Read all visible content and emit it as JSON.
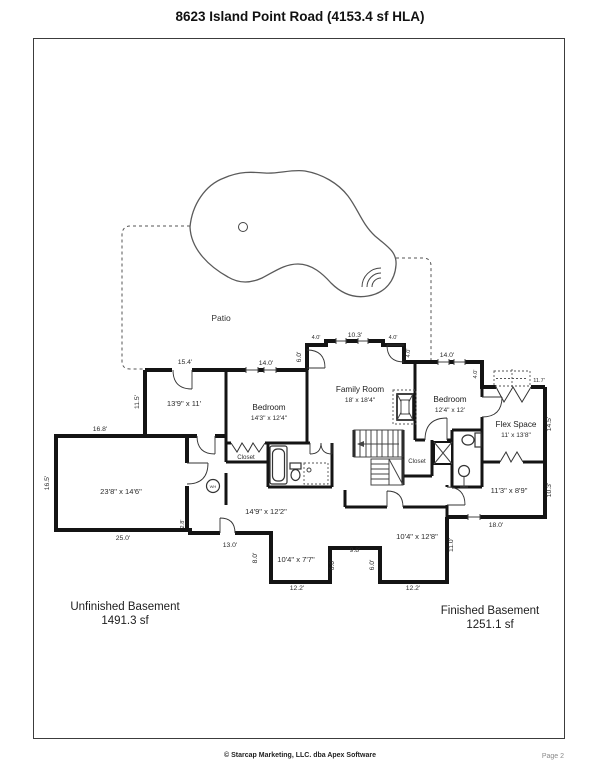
{
  "page": {
    "title": "8623 Island Point Road (4153.4 sf HLA)",
    "footer_copyright": "© Starcap Marketing, LLC. dba Apex Software",
    "footer_page": "Page 2"
  },
  "areas": {
    "unfinished": {
      "name": "Unfinished Basement",
      "sqft": "1491.3 sf"
    },
    "finished": {
      "name": "Finished Basement",
      "sqft": "1251.1 sf"
    }
  },
  "colors": {
    "wall": "#141414",
    "dashed": "#555555",
    "text": "#222222",
    "page_bg": "#ffffff"
  },
  "labels": [
    {
      "t": "Patio",
      "x": 221,
      "y": 321,
      "s": "patio",
      "n": "patio-label"
    },
    {
      "t": "Family Room",
      "x": 360,
      "y": 392,
      "s": "room",
      "n": "room-label"
    },
    {
      "t": "18' x 18'4\"",
      "x": 360,
      "y": 402,
      "s": "roomsub",
      "n": "room-size-label"
    },
    {
      "t": "Bedroom",
      "x": 269,
      "y": 410,
      "s": "room",
      "n": "room-label"
    },
    {
      "t": "14'3\" x 12'4\"",
      "x": 269,
      "y": 420,
      "s": "roomsub",
      "n": "room-size-label"
    },
    {
      "t": "Bedroom",
      "x": 450,
      "y": 402,
      "s": "room",
      "n": "room-label"
    },
    {
      "t": "12'4\" x 12'",
      "x": 450,
      "y": 412,
      "s": "roomsub",
      "n": "room-size-label"
    },
    {
      "t": "Flex Space",
      "x": 516,
      "y": 427,
      "s": "room",
      "n": "room-label"
    },
    {
      "t": "11' x 13'8\"",
      "x": 516,
      "y": 437,
      "s": "roomsub",
      "n": "room-size-label"
    },
    {
      "t": "13'9\" x 11'",
      "x": 184,
      "y": 406,
      "s": "roomdim",
      "n": "room-size-label"
    },
    {
      "t": "23'8\" x 14'6\"",
      "x": 121,
      "y": 494,
      "s": "roomdim",
      "n": "room-size-label"
    },
    {
      "t": "14'9\" x 12'2\"",
      "x": 266,
      "y": 514,
      "s": "roomdim",
      "n": "room-size-label"
    },
    {
      "t": "11'3\" x 8'9\"",
      "x": 509,
      "y": 493,
      "s": "roomdim",
      "n": "room-size-label"
    },
    {
      "t": "10'4\" x 7'7\"",
      "x": 296,
      "y": 562,
      "s": "roomdim",
      "n": "room-size-label"
    },
    {
      "t": "10'4\" x 12'8\"",
      "x": 417,
      "y": 539,
      "s": "roomdim",
      "n": "room-size-label"
    },
    {
      "t": "Closet",
      "x": 246,
      "y": 459,
      "s": "closet",
      "n": "closet-label"
    },
    {
      "t": "Closet",
      "x": 417,
      "y": 463,
      "s": "closet",
      "n": "closet-label"
    },
    {
      "t": "WH",
      "x": 213,
      "y": 488,
      "s": "wh",
      "n": "water-heater-label"
    },
    {
      "t": "10.3'",
      "x": 355,
      "y": 337,
      "s": "dim",
      "n": "dimension-label"
    },
    {
      "t": "4.0'",
      "x": 316,
      "y": 339,
      "s": "dimsmall",
      "n": "dimension-label"
    },
    {
      "t": "4.0'",
      "x": 393,
      "y": 339,
      "s": "dimsmall",
      "n": "dimension-label"
    },
    {
      "t": "6.0'",
      "x": 301,
      "y": 357,
      "s": "dim",
      "r": -90,
      "n": "dimension-label"
    },
    {
      "t": "4.0'",
      "x": 410,
      "y": 353,
      "s": "dimsmall",
      "r": -90,
      "n": "dimension-label"
    },
    {
      "t": "14.0'",
      "x": 266,
      "y": 365,
      "s": "dim",
      "n": "dimension-label"
    },
    {
      "t": "15.4'",
      "x": 185,
      "y": 364,
      "s": "dim",
      "n": "dimension-label"
    },
    {
      "t": "14.0'",
      "x": 447,
      "y": 357,
      "s": "dim",
      "n": "dimension-label"
    },
    {
      "t": "4.0'",
      "x": 477,
      "y": 374,
      "s": "dimsmall",
      "r": -90,
      "n": "dimension-label"
    },
    {
      "t": "11.7'",
      "x": 539,
      "y": 382,
      "s": "dimsmall",
      "n": "dimension-label"
    },
    {
      "t": "11.5'",
      "x": 139,
      "y": 402,
      "s": "dim",
      "r": -90,
      "n": "dimension-label"
    },
    {
      "t": "16.8'",
      "x": 100,
      "y": 431,
      "s": "dim",
      "n": "dimension-label"
    },
    {
      "t": "16.5'",
      "x": 49,
      "y": 483,
      "s": "dim",
      "r": -90,
      "n": "dimension-label"
    },
    {
      "t": "14.5'",
      "x": 551,
      "y": 424,
      "s": "dim",
      "r": -90,
      "n": "dimension-label"
    },
    {
      "t": "10.3'",
      "x": 551,
      "y": 490,
      "s": "dim",
      "r": -90,
      "n": "dimension-label"
    },
    {
      "t": "25.0'",
      "x": 123,
      "y": 540,
      "s": "dim",
      "n": "dimension-label"
    },
    {
      "t": "2.8'",
      "x": 184,
      "y": 524,
      "s": "dimsmall",
      "r": -90,
      "n": "dimension-label"
    },
    {
      "t": "13.0'",
      "x": 230,
      "y": 547,
      "s": "dim",
      "n": "dimension-label"
    },
    {
      "t": "8.0'",
      "x": 257,
      "y": 558,
      "s": "dim",
      "r": -90,
      "n": "dimension-label"
    },
    {
      "t": "12.2'",
      "x": 297,
      "y": 590,
      "s": "dim",
      "n": "dimension-label"
    },
    {
      "t": "6.0'",
      "x": 334,
      "y": 565,
      "s": "dim",
      "r": -90,
      "n": "dimension-label"
    },
    {
      "t": "9.8'",
      "x": 355,
      "y": 552,
      "s": "dim",
      "n": "dimension-label"
    },
    {
      "t": "6.0'",
      "x": 374,
      "y": 565,
      "s": "dim",
      "r": -90,
      "n": "dimension-label"
    },
    {
      "t": "12.2'",
      "x": 413,
      "y": 590,
      "s": "dim",
      "n": "dimension-label"
    },
    {
      "t": "11.0'",
      "x": 453,
      "y": 545,
      "s": "dim",
      "r": -90,
      "n": "dimension-label"
    },
    {
      "t": "18.0'",
      "x": 496,
      "y": 527,
      "s": "dim",
      "n": "dimension-label"
    }
  ]
}
